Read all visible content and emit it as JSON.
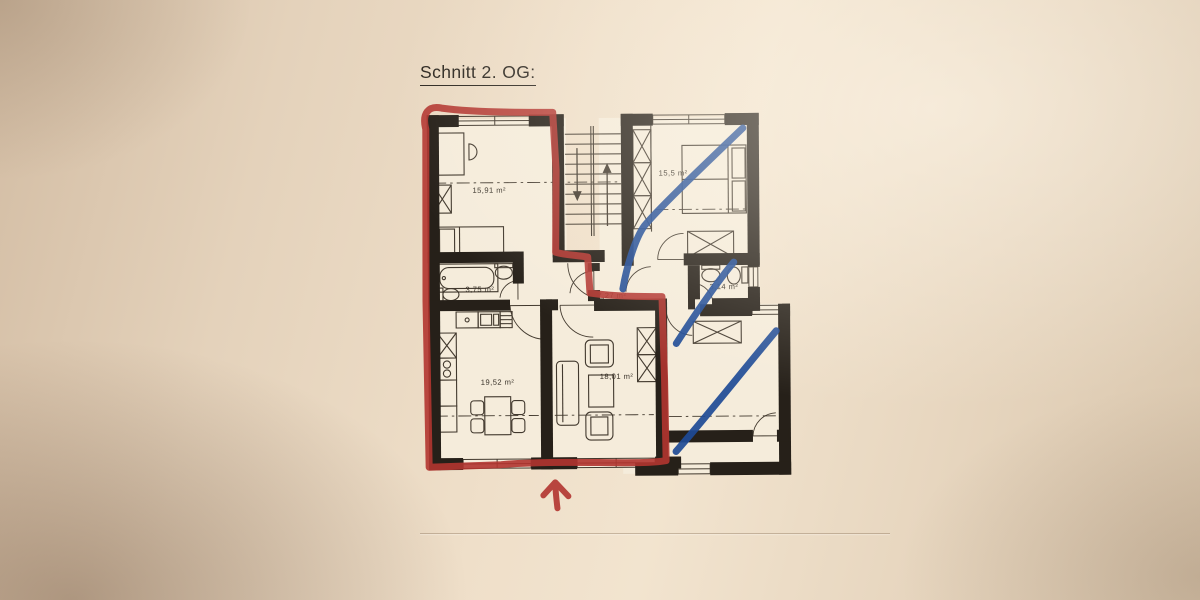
{
  "title": "Schnitt 2. OG:",
  "rooms": [
    {
      "id": "room-top-left",
      "label": "15,91 m²"
    },
    {
      "id": "bedroom-top-right",
      "label": "15,5 m²"
    },
    {
      "id": "bathroom",
      "label": "3,75 m²"
    },
    {
      "id": "hallway",
      "label": "7,27 m²"
    },
    {
      "id": "wc",
      "label": "3,14 m²"
    },
    {
      "id": "kitchen-dining",
      "label": "19,52 m²"
    },
    {
      "id": "living-room",
      "label": "18,01 m²"
    }
  ],
  "colors": {
    "red_marker": "#b23530",
    "blue_marker": "#1d4a96",
    "ink": "#262019",
    "thin_ink": "#42392e",
    "paper": "#f5ecdb"
  }
}
